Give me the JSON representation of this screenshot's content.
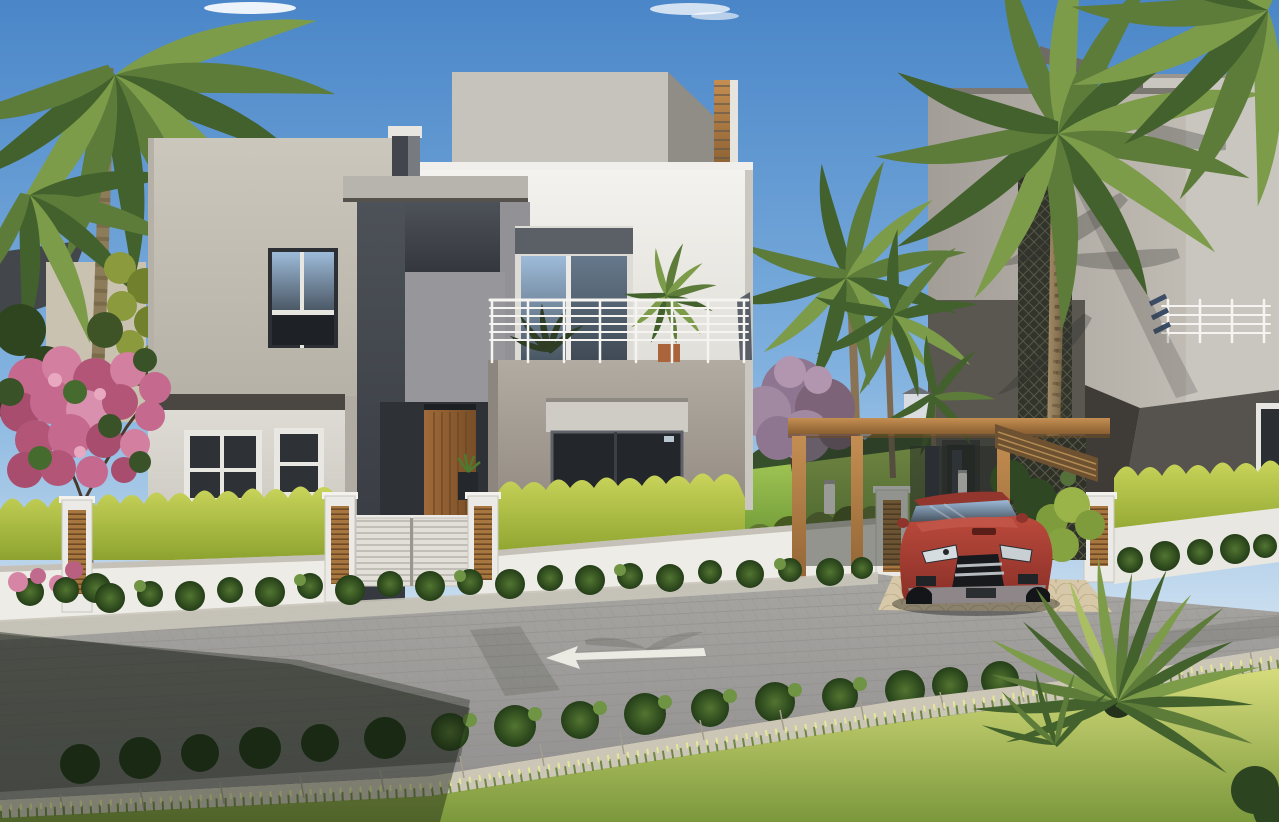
{
  "scene": {
    "description": "Daytime 3D exterior rendering of a modern cubist villa street view",
    "weather": "clear blue sky with a few small clouds",
    "buildings": {
      "main_villa": "two-storey white, beige and charcoal cubic villa with roof penthouse, recessed timber entrance door, upper balcony with white bar railing and potted plants",
      "right_villa": "neighbouring grey villa with dark lattice wall screen, rooftop railing and palm-frond shadows cast on the facade",
      "left_villa": "partially visible neighbouring house hidden behind a flowering tree"
    },
    "vehicle": "red sports sedan parked under a timber pergola carport",
    "street": {
      "surface": "grey cobblestone pavers",
      "marking": "white lane arrow painted on the road pointing left",
      "driveway": "cream fan-patterned paver apron at the carport"
    },
    "fence": "low white garden wall with timber-louvre pillars and a white slatted pedestrian gate",
    "landscaping": [
      "tall palm trees at left, centre and right",
      "pink bougainvillea tree at the left",
      "purple flowering tree behind the fence",
      "yellow-green trimmed hedges behind the white wall",
      "dark green shrub rows along both sides of the street",
      "sunlit lawn strip in the foreground",
      "sago-palm cycad in the right foreground"
    ]
  },
  "palette": {
    "sky-top": "#4a86c8",
    "sky-mid": "#7fb0de",
    "sky-horizon": "#d7e6f2",
    "cloud": "#ffffff",
    "wall-white": "#eceae5",
    "wall-beige": "#c4c0b5",
    "wall-gray": "#96959a",
    "wall-charcoal": "#42464d",
    "balcony-gray": "#a49d94",
    "ground-floor": "#d4d1c9",
    "penthouse-gray": "#c6c3bc",
    "neighbor-light": "#b2ada6",
    "neighbor-dark": "#57534e",
    "lattice": "#32342c",
    "wood": "#b5854f",
    "wood-dark": "#7a5a33",
    "door-wood": "#8f5e33",
    "hedge-green": "#b3c24a",
    "shrub-green": "#3c5c28",
    "lawn-green": "#8cb84a",
    "grass-light": "#ccd470",
    "grass-dark": "#7f9c3f",
    "palm-green": "#5d7c3a",
    "palm-light": "#7d9c4a",
    "palm-dark": "#42612c",
    "trunk-brown": "#93805e",
    "flower-pink": "#cf6f92",
    "flower-purple": "#977b95",
    "road-gray": "#a19f9b",
    "curb-stone": "#ccc6b6",
    "driveway-tan": "#d6c8a8",
    "sidewalk": "#c9c5ba",
    "car-red": "#b2463a",
    "car-red-dark": "#8e3129",
    "glass-dark": "#2b3036",
    "railing-white": "#f5f4f1",
    "arrow-white": "#efeee7"
  }
}
